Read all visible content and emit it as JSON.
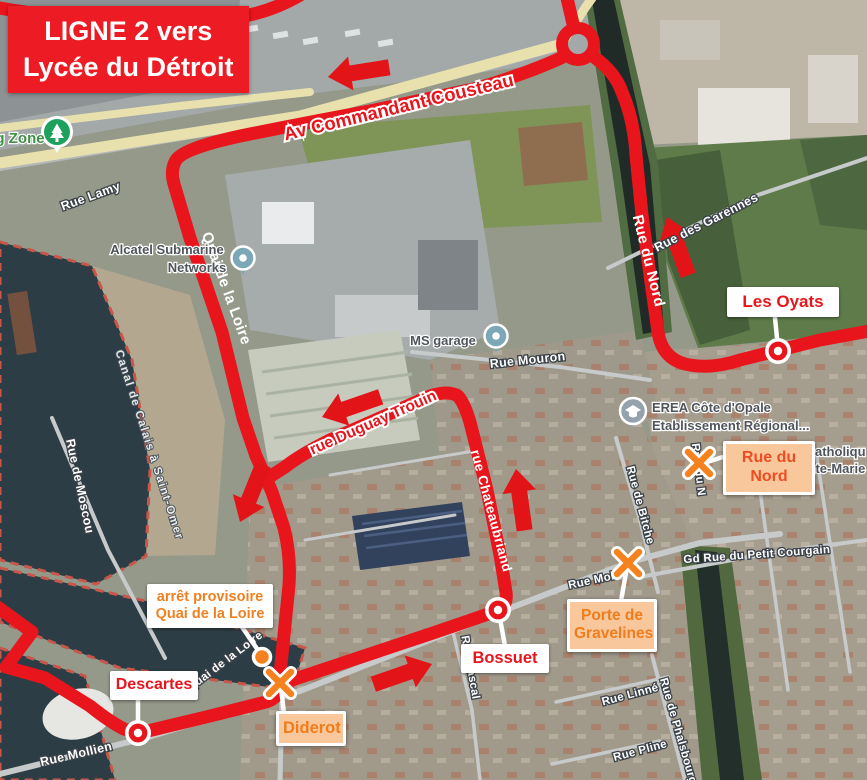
{
  "title": {
    "line1": "LIGNE 2 vers",
    "line2": "Lycée du Détroit"
  },
  "callouts": {
    "les_oyats": "Les Oyats",
    "bossuet": "Bossuet",
    "descartes": "Descartes",
    "diderot": "Diderot",
    "porte_line1": "Porte de",
    "porte_line2": "Gravelines",
    "rue_du_nord": "Rue du Nord",
    "arret_line1": "arrêt provisoire",
    "arret_line2": "Quai de la Loire"
  },
  "route_labels": {
    "cousteau": "Av Commandant Cousteau",
    "quai": "Quai de la Loire",
    "nord": "Rue du Nord",
    "chateaubriand": "rue Chateaubriand",
    "duguay": "rue Duguay Trouin"
  },
  "streets": {
    "lamy": "Rue Lamy",
    "moscou": "Rue de Moscou",
    "canal": "Canal de Calais à Saint-Omer",
    "mouron": "Rue Mouron",
    "garennes": "Rue des Garennes",
    "mollien": "Rue Mollien",
    "mollien_e": "Rue Mol",
    "quai_g": "Quai de la Loire",
    "bitche": "Rue de Bitche",
    "rue_du_n": "Rue du N",
    "gd_rue": "Gd Rue du Petit Courgain",
    "linne": "Rue Linné",
    "phalsbourg": "Rue de Phalsbourg",
    "pline": "Rue Pline",
    "pascal": "Rue Pascal"
  },
  "pois": {
    "alcatel_line1": "Alcatel Submarine",
    "alcatel_line2": "Networks",
    "ms_garage": "MS garage",
    "erea_line1": "EREA Côte d'Opale",
    "erea_line2": "Etablissement Régional...",
    "zone": "g Zone",
    "catholique_frag1": "atholiqu",
    "catholique_frag2": "Sainte-Marie"
  },
  "colors": {
    "route_red": "#e8151d",
    "title_bg": "#ed1b23",
    "stop_marker_orange": "#f5821f",
    "callout_peach": "#f8c79c",
    "rue_du_nord_text": "#ee4d22",
    "water": "#2d3d45",
    "yellow_road": "#e8e1ae"
  }
}
